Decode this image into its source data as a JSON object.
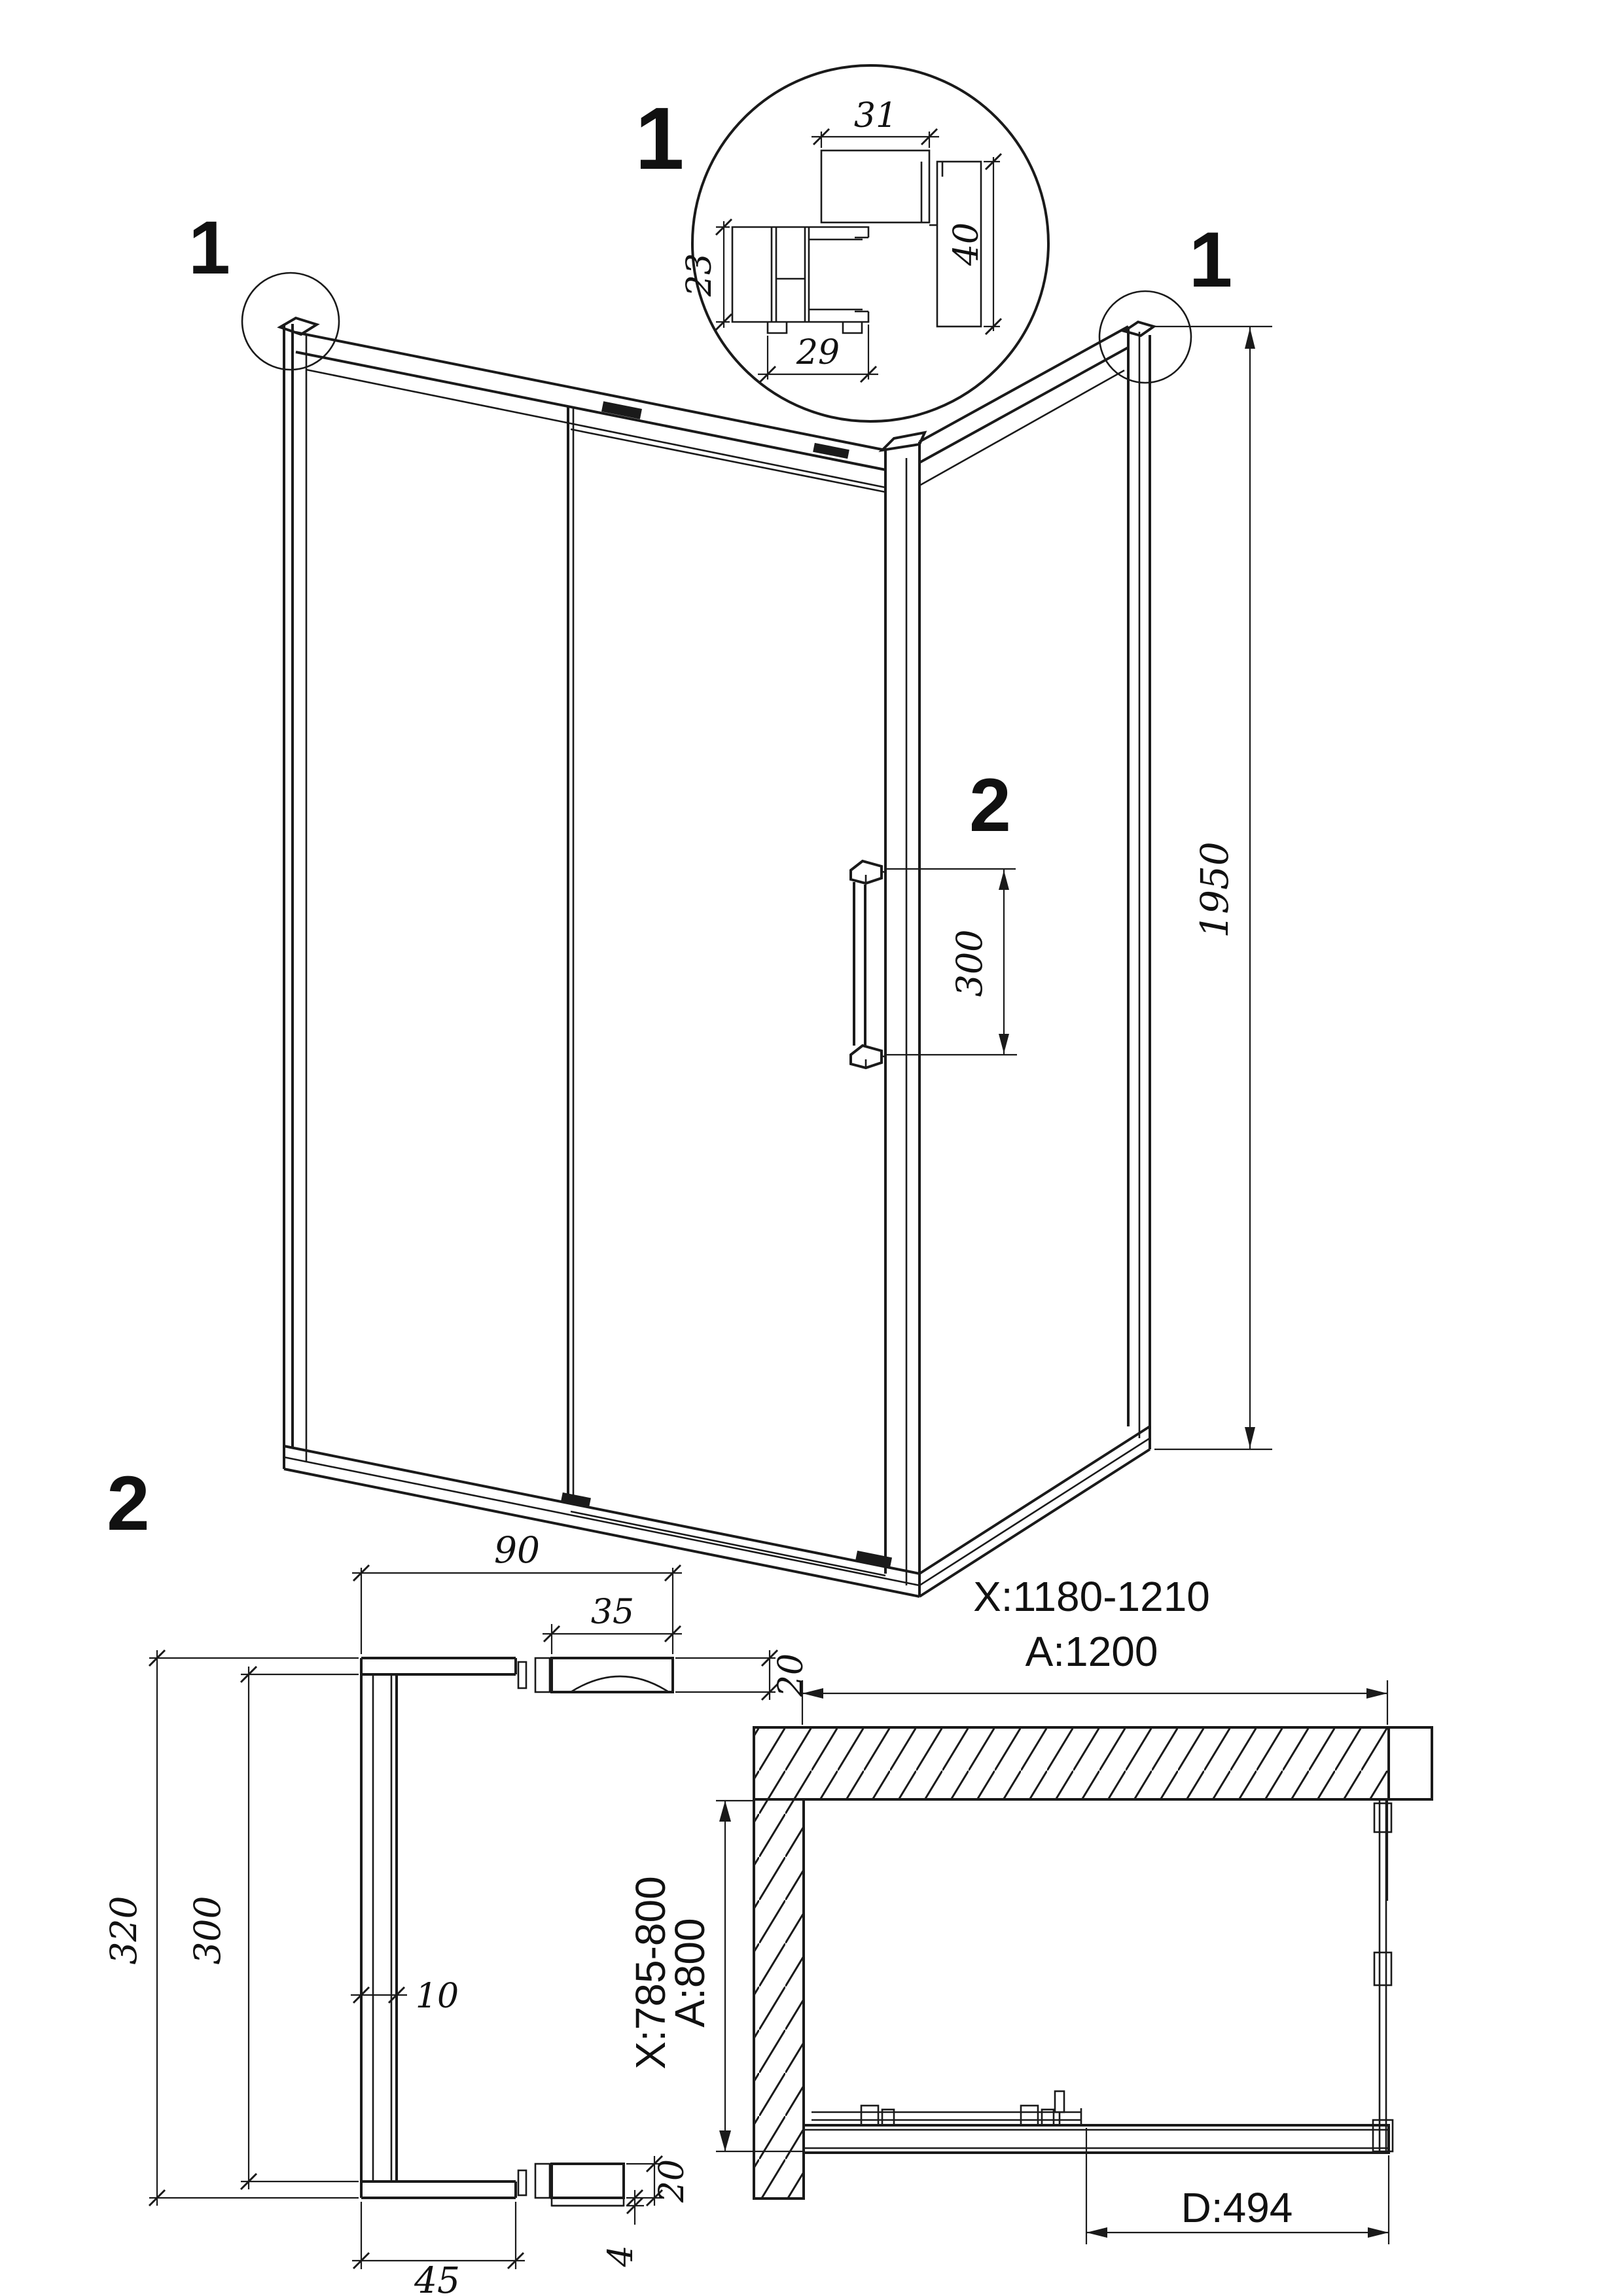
{
  "colors": {
    "line": "#1a1a1a",
    "background": "#ffffff"
  },
  "detail_section_1": {
    "label": "1",
    "dims": {
      "top": "31",
      "right": "40",
      "left": "23",
      "bottom": "29"
    }
  },
  "iso_view": {
    "callout_left": "1",
    "callout_right": "1",
    "handle_ref": "2",
    "dims": {
      "height": "1950",
      "handle_length": "300"
    }
  },
  "handle_detail": {
    "label": "2",
    "dims": {
      "overall_width": "90",
      "mount_width": "35",
      "mount_height_top": "20",
      "overall_length": "320",
      "inner_length": "300",
      "bar_thickness": "10",
      "mount_height_bottom": "20",
      "washer": "4",
      "foot_width": "45"
    }
  },
  "plan_view": {
    "dims": {
      "width_adjustable": "X:1180-1210",
      "width_nominal": "A:1200",
      "depth_adjustable": "X:785-800",
      "depth_nominal": "A:800",
      "door_opening": "D:494"
    }
  }
}
